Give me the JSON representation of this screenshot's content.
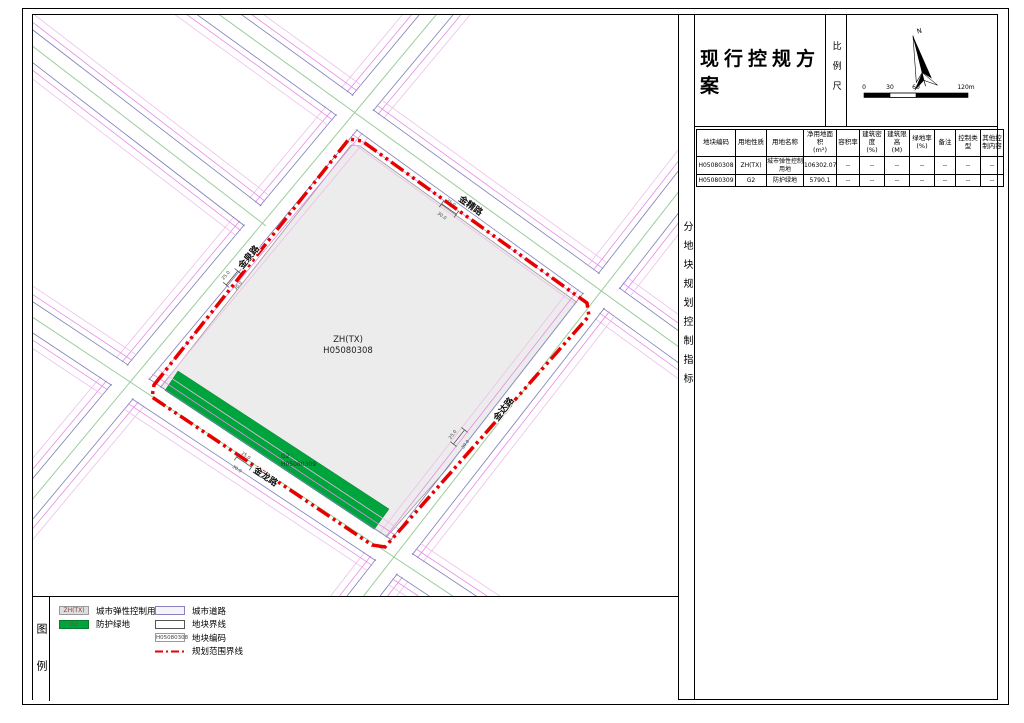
{
  "title_block": {
    "title": "现行控规方案",
    "scale_bar_label": "比例尺",
    "north_label": "N",
    "scale_ticks": [
      "0",
      "30",
      "60",
      "120m"
    ]
  },
  "side_panel": {
    "vertical_label": "分地块规划控制指标"
  },
  "indicator_table": {
    "headers": [
      "地块编码",
      "用地性质",
      "用地名称",
      "净用地面积\n(m²)",
      "容积率",
      "建筑密度\n(%)",
      "建筑限高\n(M)",
      "绿地率\n(%)",
      "备注",
      "控制类型",
      "其他控制内容"
    ],
    "rows": [
      [
        "H05080308",
        "ZH(TX)",
        "城市弹性控制用地",
        "106302.07",
        "--",
        "--",
        "--",
        "--",
        "--",
        "--",
        "--"
      ],
      [
        "H05080309",
        "G2",
        "防护绿地",
        "5790.1",
        "--",
        "--",
        "--",
        "--",
        "--",
        "--",
        "--"
      ]
    ]
  },
  "map": {
    "site": {
      "code_type": "ZH(TX)",
      "code": "H05080308"
    },
    "green_belt": {
      "code_type": "G2",
      "code": "H05080309"
    },
    "roads": [
      {
        "name": "金泉路"
      },
      {
        "name": "金精路"
      },
      {
        "name": "金达路"
      },
      {
        "name": "金龙路"
      }
    ],
    "dimensions": [
      {
        "labels": [
          "25.0",
          "30.0"
        ]
      },
      {
        "labels": [
          "25.0",
          "30.0"
        ]
      },
      {
        "labels": [
          "25.0",
          "30.0"
        ]
      },
      {
        "labels": [
          "25.0",
          "30.0"
        ]
      }
    ]
  },
  "legend": {
    "vertical_label": "图例",
    "items": [
      {
        "column": "left",
        "type": "landuse-gray",
        "swatch_text": "ZH(TX)",
        "label": "城市弹性控制用地"
      },
      {
        "column": "left",
        "type": "landuse-green",
        "swatch_text": "G2",
        "label": "防护绿地"
      },
      {
        "column": "right",
        "type": "road",
        "swatch_text": "",
        "label": "城市道路"
      },
      {
        "column": "right",
        "type": "boundary",
        "swatch_text": "",
        "label": "地块界线"
      },
      {
        "column": "right",
        "type": "code",
        "swatch_text": "H05080308",
        "label": "地块编码"
      },
      {
        "column": "right",
        "type": "redline",
        "swatch_text": "",
        "label": "规划范围界线"
      }
    ]
  },
  "colors": {
    "planning_boundary_red": "#e60000",
    "green_belt": "#00a43c",
    "site_gray": "#ececec",
    "road_edge_blue": "#7d7dbb",
    "road_edge_magenta": "#e88ae8",
    "road_edge_pink": "#f0bdec",
    "road_center_green": "#9ccc9c"
  }
}
